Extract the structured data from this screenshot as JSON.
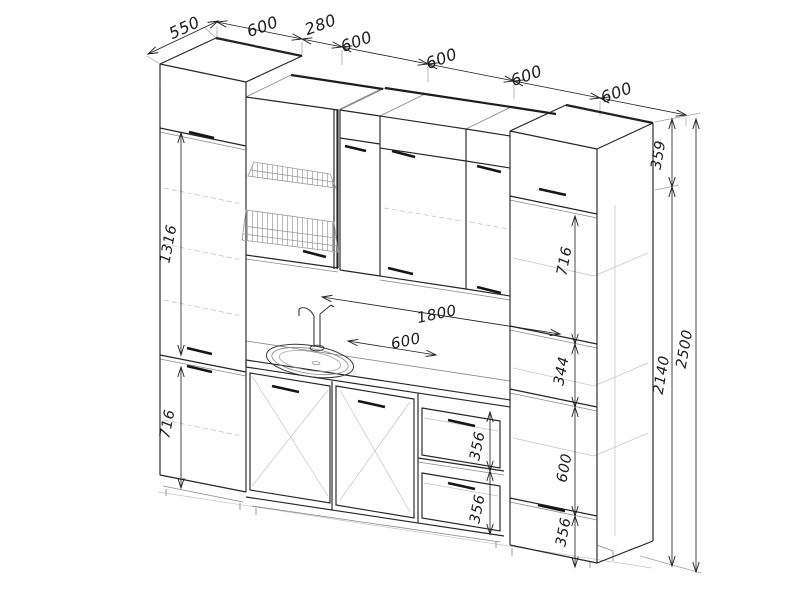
{
  "drawing_type": "kitchen-cabinet-technical-drawing",
  "colors": {
    "background": "#ffffff",
    "line_dark": "#262626",
    "line_heavy": "#1d1d1d",
    "line_medium": "#8a8a8a",
    "line_light": "#c4c4c4",
    "dimension": "#1b1b1b"
  },
  "dimensions": {
    "top": [
      {
        "name": "pantry-depth",
        "value": "550"
      },
      {
        "name": "pantry-width",
        "value": "600"
      },
      {
        "name": "upper-cabinet-narrow-width",
        "value": "280"
      },
      {
        "name": "upper-cabinet-1-width",
        "value": "600"
      },
      {
        "name": "upper-cabinet-2-width",
        "value": "600"
      },
      {
        "name": "upper-cabinet-3-width",
        "value": "600"
      },
      {
        "name": "right-top-cabinet-width",
        "value": "600"
      }
    ],
    "left_column": [
      {
        "name": "pantry-upper-door-height",
        "value": "1316"
      },
      {
        "name": "pantry-lower-door-height",
        "value": "716"
      }
    ],
    "counter": [
      {
        "name": "worktop-length",
        "value": "1800"
      },
      {
        "name": "sink-cabinet-width",
        "value": "600"
      }
    ],
    "drawers": [
      {
        "name": "drawer-1-height",
        "value": "356"
      },
      {
        "name": "drawer-2-height",
        "value": "356"
      }
    ],
    "right_column": [
      {
        "name": "right-upper-section-height",
        "value": "716"
      },
      {
        "name": "right-shelf-gap-height",
        "value": "344"
      },
      {
        "name": "oven-cavity-height",
        "value": "600"
      },
      {
        "name": "right-bottom-drawer-height",
        "value": "356"
      }
    ],
    "right_overall": [
      {
        "name": "top-cabinet-height",
        "value": "359"
      },
      {
        "name": "cabinet-body-height",
        "value": "2140"
      },
      {
        "name": "total-height",
        "value": "2500"
      }
    ]
  }
}
